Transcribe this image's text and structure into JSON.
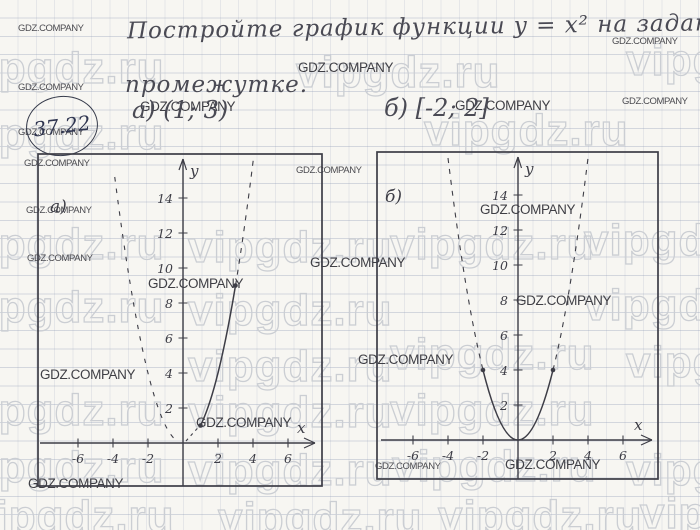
{
  "page": {
    "title_line1": "Постройте график функции y = x² на заданном",
    "title_line2": "промежутке.",
    "problem_number": "37.22",
    "part_a_header": "а) (1; 3)",
    "part_b_header": "б) [-2; 2]"
  },
  "watermarks": {
    "vip": "vipgdz.ru",
    "gdz": "GDZ.COMPANY"
  },
  "graphs": {
    "a": {
      "label": "а)",
      "y_axis_label": "y",
      "x_axis_label": "x",
      "y_ticks": [
        "14",
        "12",
        "10",
        "8",
        "6",
        "4",
        "2"
      ],
      "x_ticks": [
        "-6",
        "-4",
        "-2",
        "2",
        "4",
        "6"
      ]
    },
    "b": {
      "label": "б)",
      "y_axis_label": "y",
      "x_axis_label": "x",
      "y_ticks": [
        "14",
        "12",
        "10",
        "8",
        "6",
        "4",
        "2"
      ],
      "x_ticks": [
        "-6",
        "-4",
        "-2",
        "2",
        "4",
        "6"
      ]
    }
  },
  "chart_data": [
    {
      "type": "line",
      "title": "а) y = x² на промежутке (1; 3)",
      "x": [
        1,
        1.5,
        2,
        2.5,
        3
      ],
      "y": [
        1,
        2.25,
        4,
        6.25,
        9
      ],
      "xlabel": "x",
      "ylabel": "y",
      "xlim": [
        -8,
        8
      ],
      "ylim": [
        0,
        16
      ],
      "x_tick_labels": [
        -6,
        -4,
        -2,
        2,
        4,
        6
      ],
      "y_tick_labels": [
        2,
        4,
        6,
        8,
        10,
        12,
        14
      ],
      "notes": "solid arc from (1,1) to (3,9) with endpoint dots; rest of parabola dashed"
    },
    {
      "type": "line",
      "title": "б) y = x² на промежутке [-2; 2]",
      "x": [
        -2,
        -1,
        0,
        1,
        2
      ],
      "y": [
        4,
        1,
        0,
        1,
        4
      ],
      "xlabel": "x",
      "ylabel": "y",
      "xlim": [
        -8,
        8
      ],
      "ylim": [
        0,
        16
      ],
      "x_tick_labels": [
        -6,
        -4,
        -2,
        2,
        4,
        6
      ],
      "y_tick_labels": [
        2,
        4,
        6,
        8,
        10,
        12,
        14
      ],
      "notes": "solid arc from (-2,4) to (2,4) through (0,0) with endpoint dots; branches above dashed"
    }
  ]
}
